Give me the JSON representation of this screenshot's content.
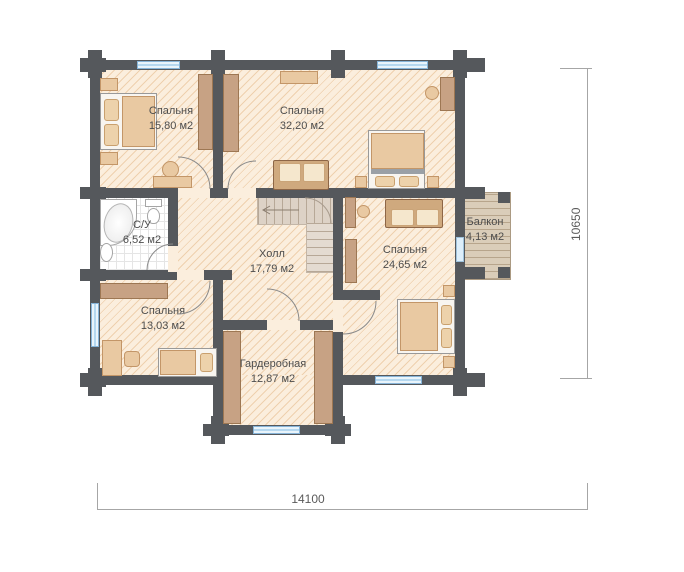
{
  "floorplan": {
    "rooms": [
      {
        "id": "bedroom-15",
        "name": "Спальня",
        "area": "15,80 м2"
      },
      {
        "id": "bedroom-32",
        "name": "Спальня",
        "area": "32,20 м2"
      },
      {
        "id": "bathroom",
        "name": "С/У",
        "area": "6,52 м2"
      },
      {
        "id": "hall",
        "name": "Холл",
        "area": "17,79 м2"
      },
      {
        "id": "bedroom-24",
        "name": "Спальня",
        "area": "24,65 м2"
      },
      {
        "id": "bedroom-13",
        "name": "Спальня",
        "area": "13,03 м2"
      },
      {
        "id": "wardrobe",
        "name": "Гардеробная",
        "area": "12,87 м2"
      },
      {
        "id": "balcony",
        "name": "Балкон",
        "area": "4,13 м2"
      }
    ],
    "dimensions": {
      "width": "14100",
      "depth": "10650"
    },
    "colors": {
      "wall": "#55585c",
      "floor": "#fbeedd",
      "hatch_line": "#ddaa6c",
      "wood_furniture": "#c7a284",
      "window": "#b5d8f0",
      "balcony_deck": "#dacdb9"
    }
  }
}
